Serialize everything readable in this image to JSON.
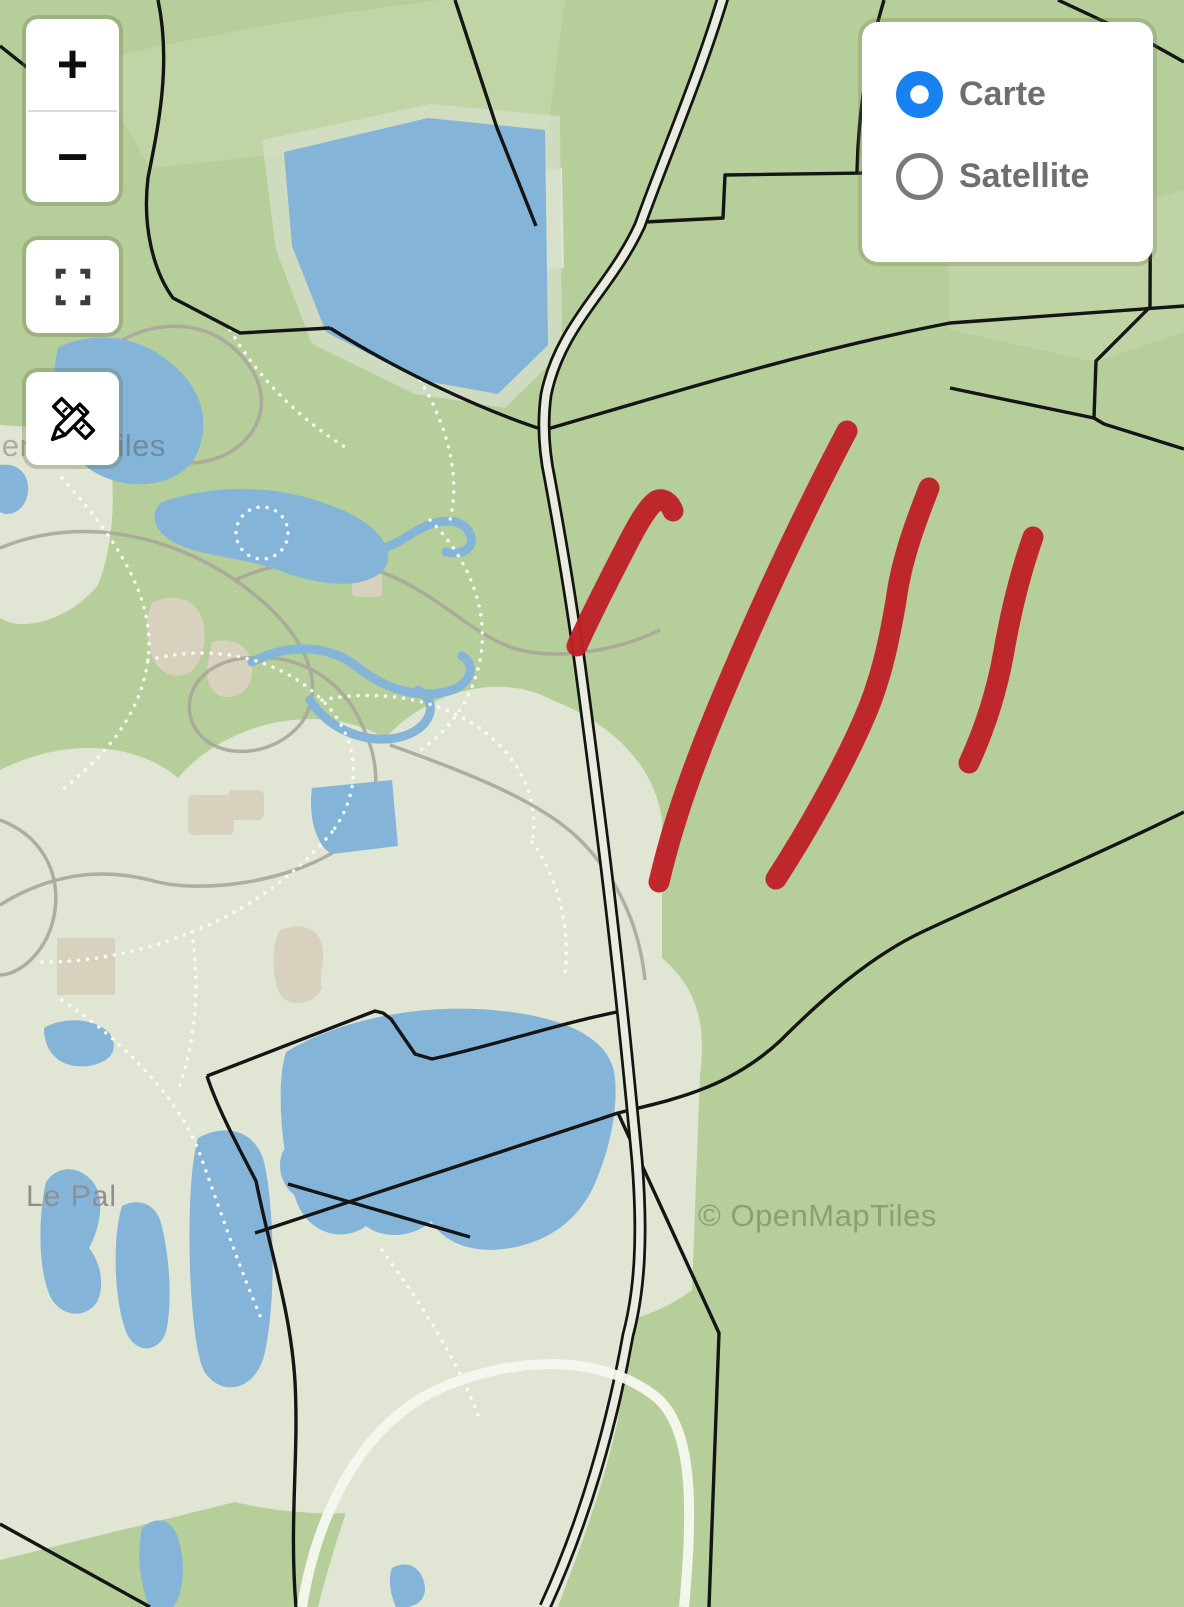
{
  "map": {
    "place_label": "Le Pal",
    "attribution": "© OpenMapTiles",
    "tile_watermark": "© OpenMapTiles"
  },
  "controls": {
    "zoom_in_label": "+",
    "zoom_out_label": "−",
    "fullscreen_icon": "fullscreen-icon",
    "draw_icon": "pencil-ruler-icon"
  },
  "layer_switcher": {
    "options": [
      {
        "label": "Carte",
        "selected": true
      },
      {
        "label": "Satellite",
        "selected": false
      }
    ],
    "selected_color": "#1781f2",
    "unselected_ring_color": "#7b7b7b",
    "label_color": "#6e6e6e"
  },
  "annotations": {
    "tool": "freehand-red-marker",
    "color": "#bf2127",
    "stroke_width": 21,
    "count": 4,
    "strokes": [
      {
        "d": "M577,646 C590,616 611,576 629,541 C641,518 649,506 656,501 C663,497 670,503 673,511"
      },
      {
        "d": "M847,431 C820,482 781,561 746,641 C711,721 682,792 664,862 L659,882"
      },
      {
        "d": "M929,488 C916,521 901,561 896,601 C889,641 881,681 863,721 C841,771 807,831 776,879"
      },
      {
        "d": "M1033,537 C1021,571 1011,611 1004,651 C997,691 986,726 969,763"
      }
    ]
  },
  "palette": {
    "land_green": "#b6ce99",
    "land_light_green": "#c4d6a9",
    "park_pale": "#e1e5d3",
    "water_blue": "#85b4d9",
    "boundary_black": "#151515",
    "road_fill": "#eaecdf",
    "path_gray": "#a9a79c",
    "building_tan": "#d8d1be"
  }
}
